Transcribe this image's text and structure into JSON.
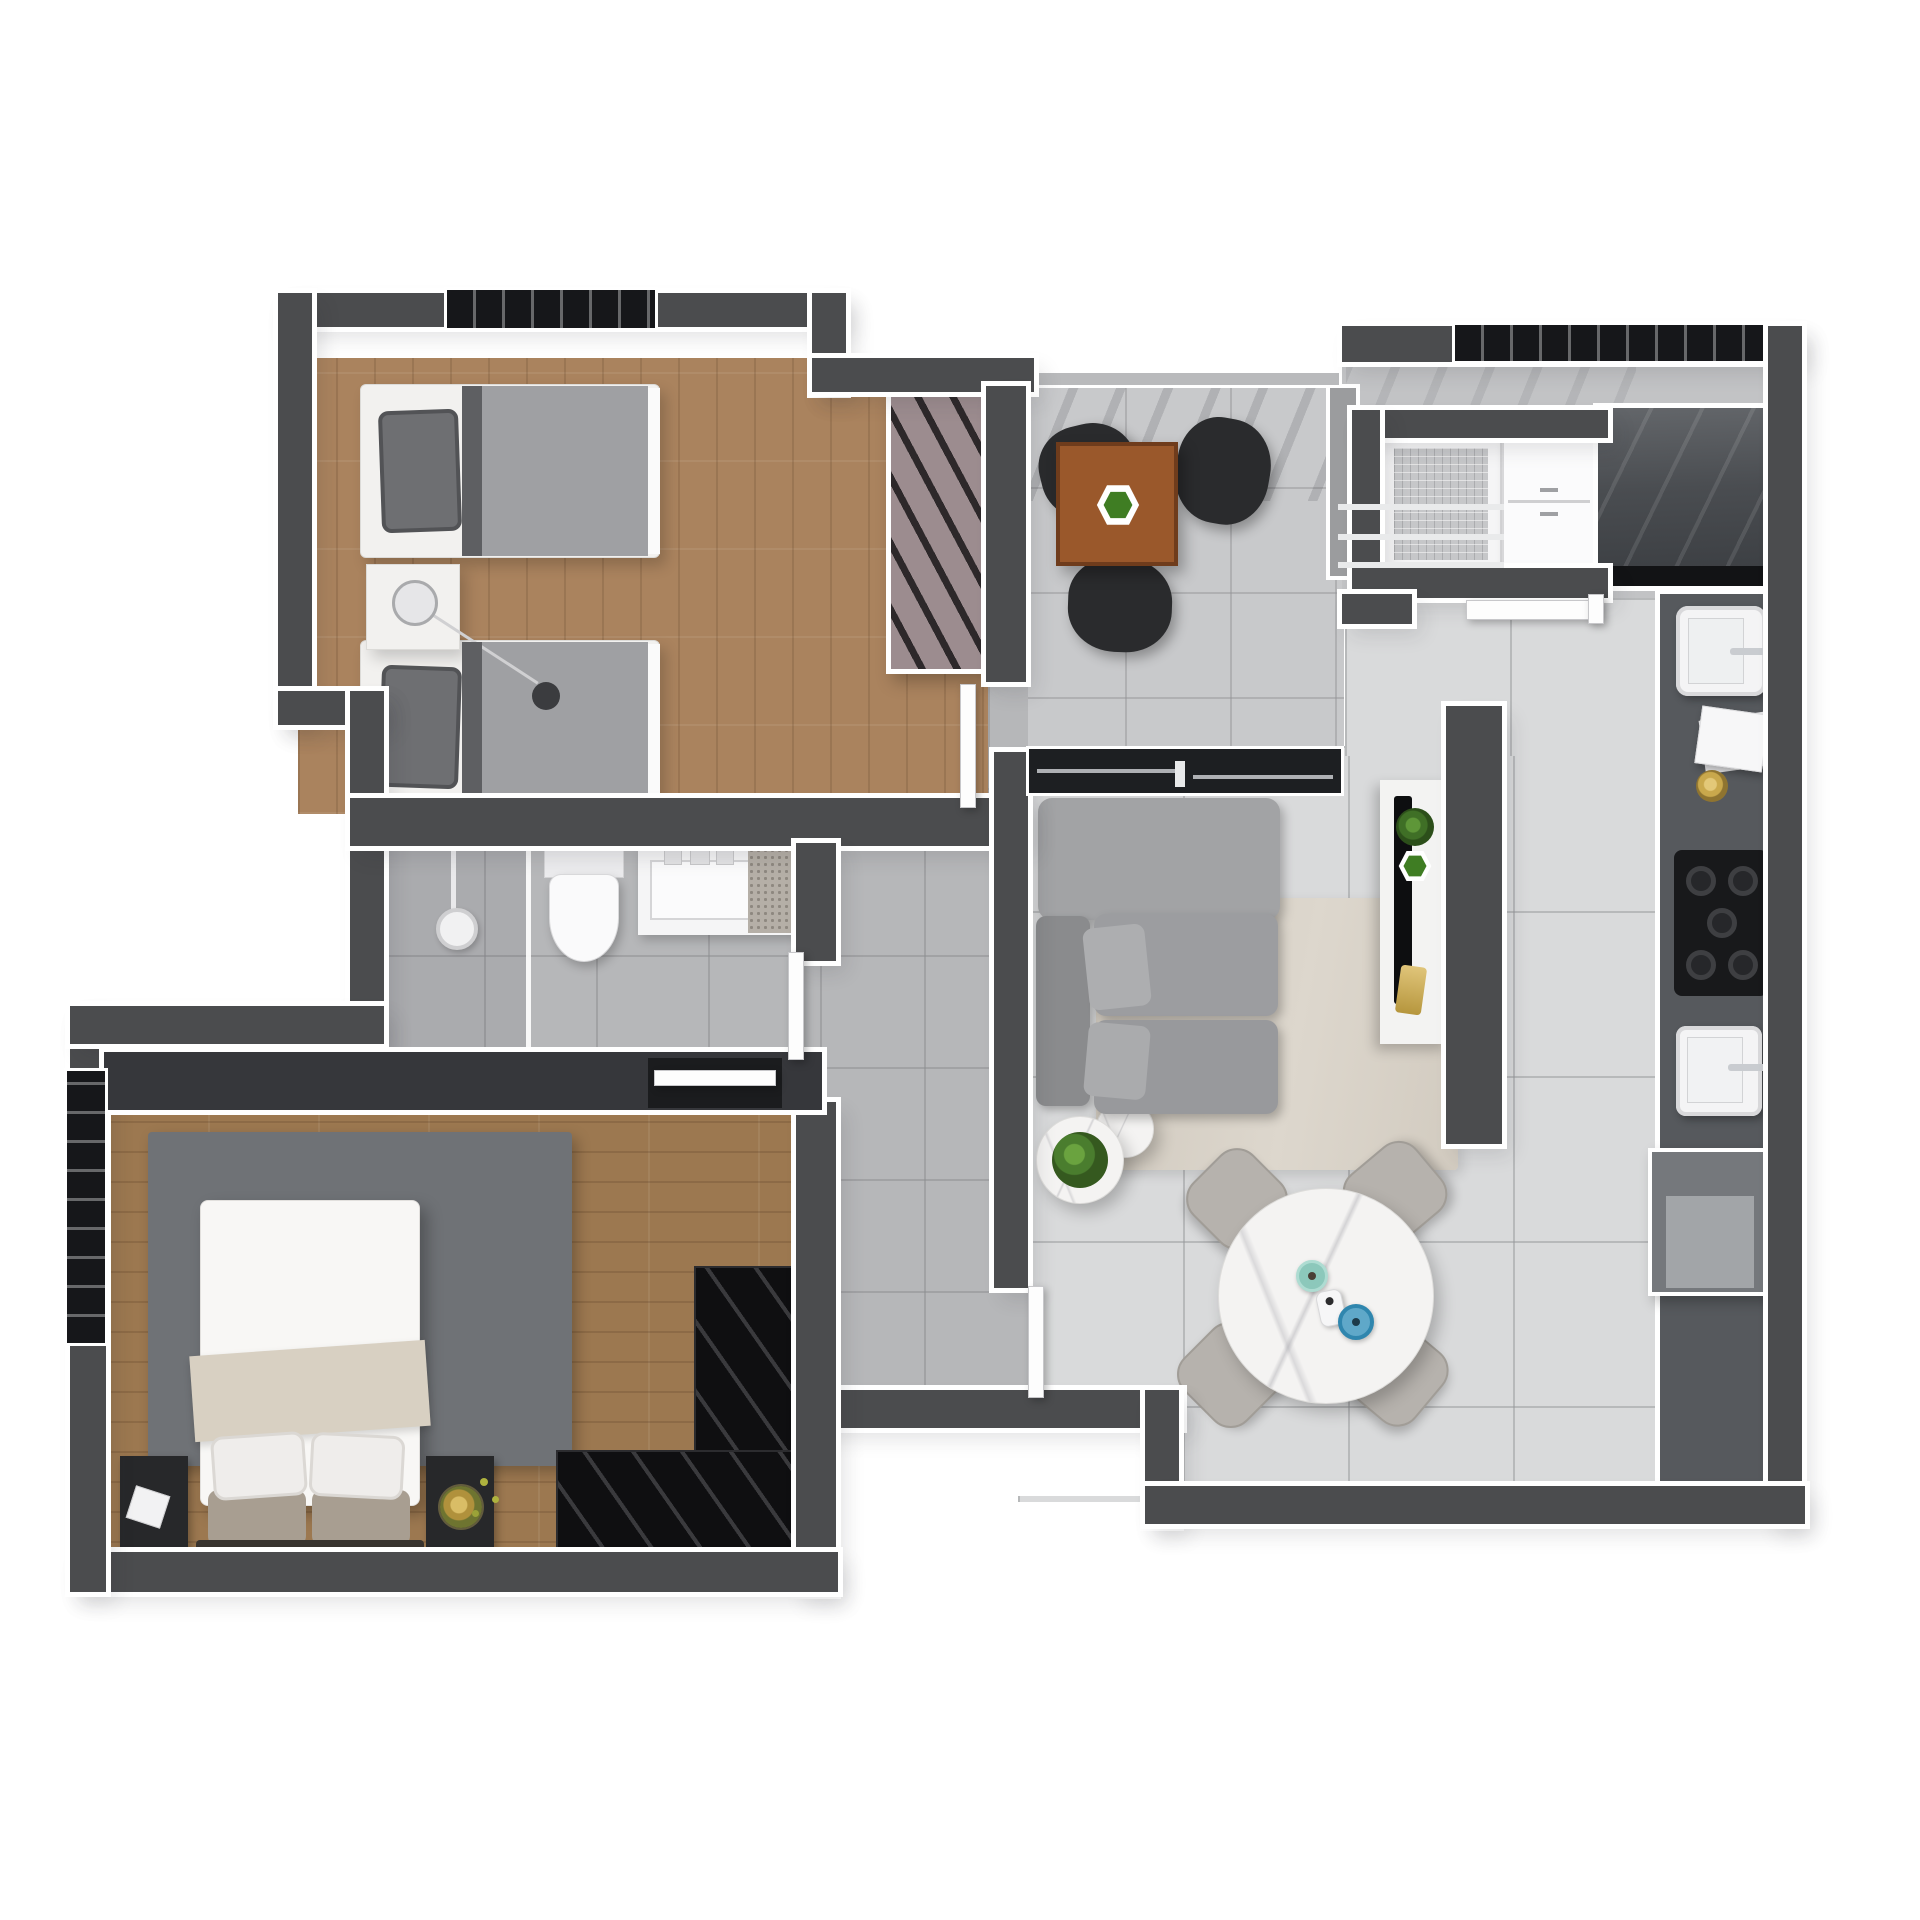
{
  "scene": {
    "kind": "3d-rendered apartment floor plan, top-down view, no visible text",
    "background": "#ffffff",
    "wall_color": "#4b4c4e",
    "wall_outline_color": "#ffffff"
  },
  "palette": {
    "wood_floor_light": "#aa835e",
    "wood_floor_dark": "#9c7850",
    "tile_living": "#d9dadb",
    "tile_bath_hall": "#b6b7b9",
    "tile_balcony": "#c8c9cb",
    "kitchen_counter": "#56595d",
    "cooktop_black": "#18191b",
    "sofa_gray": "#9c9da0",
    "rug_living_beige": "#d3ccc1",
    "rug_master_gray": "#6f7276",
    "wardrobe_mauve": "#9c8c8f",
    "wardrobe_black": "#0f0f11",
    "table_wood": "#9a582b",
    "plant_green": "#4a7d2e",
    "cup_teal": "#8cc8bb",
    "bowl_blue": "#2f86ae",
    "decor_gold": "#c9a84c",
    "duvet_twin_gray": "#9fa0a3",
    "duvet_master_white": "#f8f7f5",
    "throw_beige": "#d8d0c2"
  },
  "rooms": {
    "twin_bedroom": {
      "name": "twin-bedroom",
      "floor": "wood",
      "items": [
        "single-bed",
        "single-bed",
        "gray-duvet",
        "gray-pillow",
        "nightstand",
        "ball-lamp",
        "striped-wardrobe",
        "window",
        "hinged-door"
      ]
    },
    "balcony": {
      "name": "balcony",
      "floor": "gray-tile",
      "items": [
        "square-wood-table",
        "green-hex-planter",
        "black-chair",
        "black-chair",
        "black-chair",
        "railing",
        "sliding-glass-door"
      ]
    },
    "laundry": {
      "name": "laundry-area",
      "floor": "gray-tile",
      "items": [
        "top-load-washer",
        "drying-rack",
        "white-cabinet",
        "glossy-counter",
        "laundry-tank-sink",
        "towels",
        "gold-dish",
        "hinged-door",
        "window"
      ]
    },
    "kitchen": {
      "name": "kitchen",
      "floor": "gray-tile",
      "items": [
        "counter-run",
        "cooktop-5-burners",
        "square-sink",
        "faucet",
        "fridge-cabinet"
      ]
    },
    "living_dining": {
      "name": "living-dining-room",
      "floor": "light-gray-tile",
      "items": [
        "gray-sofa",
        "beige-rug",
        "marble-coffee-table-large",
        "marble-coffee-table-small",
        "green-plant",
        "tv-partition-wall",
        "tv-console",
        "tv",
        "hex-planter",
        "gold-candle",
        "round-marble-dining-table",
        "gray-dining-chair",
        "gray-dining-chair",
        "gray-dining-chair",
        "gray-dining-chair",
        "teal-cup",
        "white-pitcher",
        "blue-bowl"
      ]
    },
    "bathroom": {
      "name": "bathroom",
      "floor": "gray-tile",
      "items": [
        "shower-head",
        "glass-partition",
        "toilet",
        "vanity-sink",
        "granite-counter",
        "hinged-door"
      ]
    },
    "hallway": {
      "name": "hallway",
      "floor": "gray-tile",
      "items": []
    },
    "master_bedroom": {
      "name": "master-bedroom",
      "floor": "wood",
      "items": [
        "double-bed",
        "white-duvet",
        "beige-throw",
        "white-pillows",
        "gray-pillows",
        "nightstand",
        "nightstand",
        "white-book",
        "gold-tray-plant",
        "dark-gray-rug",
        "black-l-shaped-wardrobe",
        "sliding-door",
        "window"
      ]
    }
  }
}
